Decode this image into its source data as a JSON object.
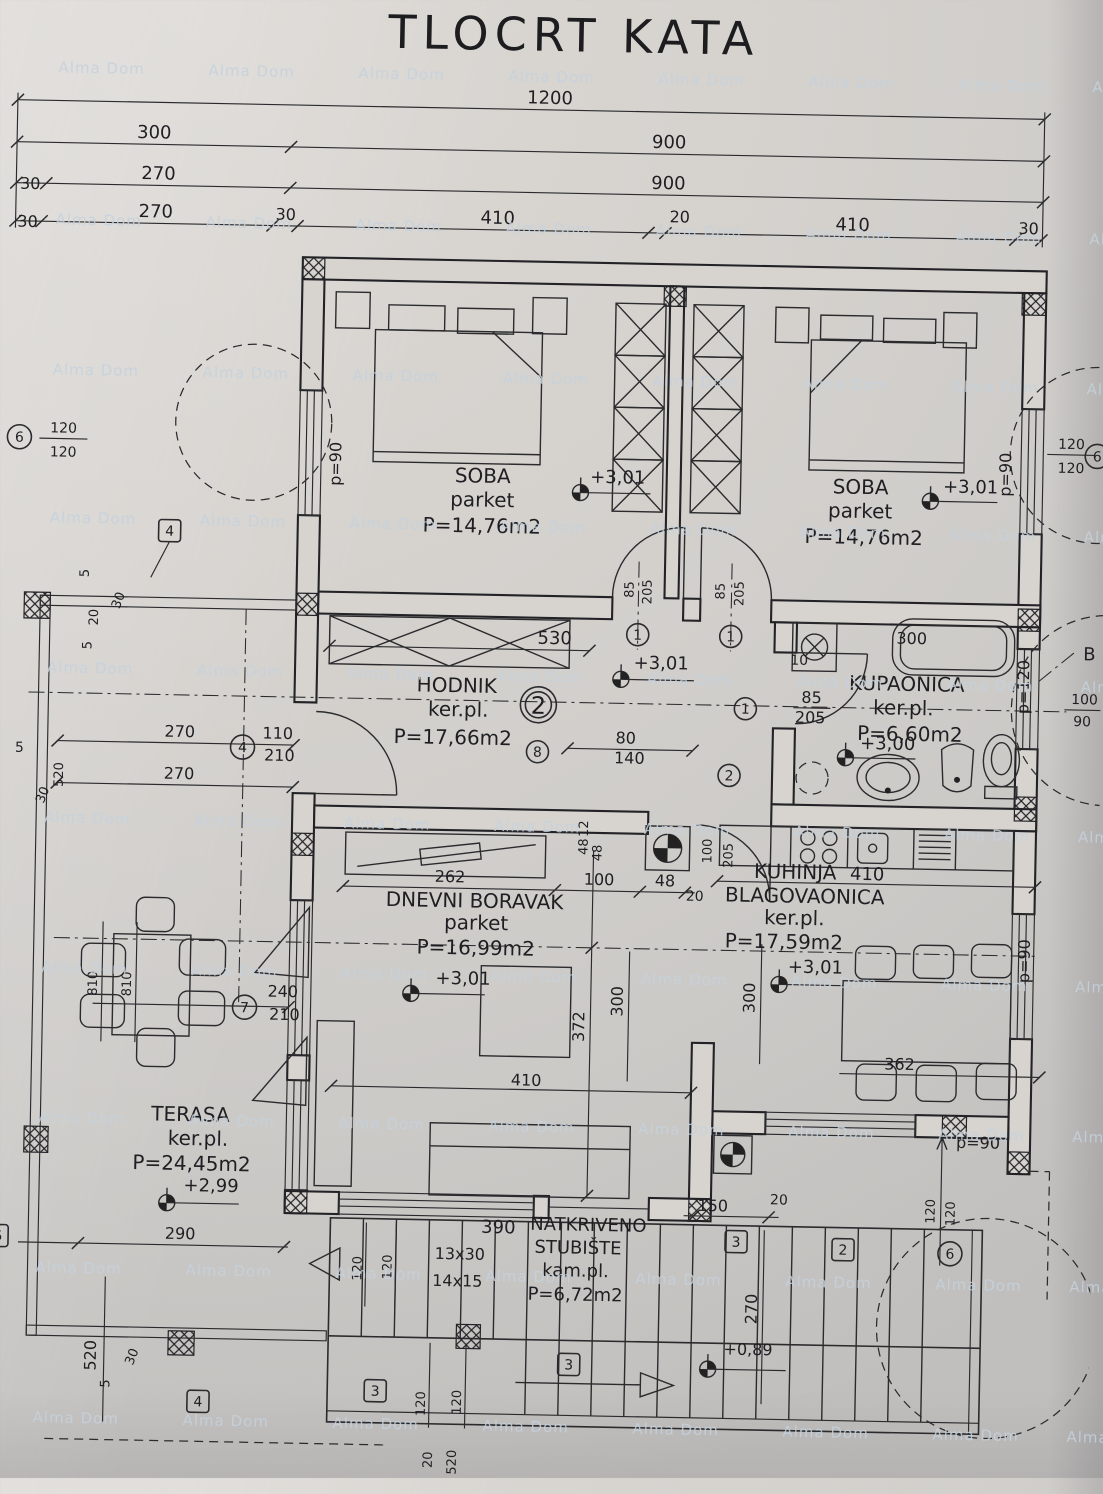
{
  "title": "TLOCRT KATA",
  "watermark": "Alma Dom",
  "section_label": "B",
  "rooms": {
    "soba1": {
      "name": "SOBA",
      "floor": "parket",
      "area": "P=14,76m2",
      "elev": "+3,01"
    },
    "soba2": {
      "name": "SOBA",
      "floor": "parket",
      "area": "P=14,76m2",
      "elev": "+3,01"
    },
    "hodnik": {
      "name": "HODNIK",
      "floor": "ker.pl.",
      "area": "P=17,66m2",
      "elev": "+3,01",
      "tag": "2"
    },
    "kupaonica": {
      "name": "KUPAONICA",
      "floor": "ker.pl.",
      "area": "P=6,60m2",
      "elev": "+3,00"
    },
    "dnevni": {
      "name": "DNEVNI BORAVAK",
      "floor": "parket",
      "area": "P=16,99m2",
      "elev": "+3,01"
    },
    "kuhinja": {
      "name": "KUHINJA",
      "name2": "BLAGOVAONICA",
      "floor": "ker.pl.",
      "area": "P=17,59m2",
      "elev": "+3,01"
    },
    "terasa": {
      "name": "TERASA",
      "floor": "ker.pl.",
      "area": "P=24,45m2",
      "elev": "+2,99"
    },
    "stubiste": {
      "name": "NATKRIVENO",
      "name2": "STUBIŠTE",
      "floor": "kam.pl.",
      "area": "P=6,72m2",
      "elev": "+0,89",
      "steps1": "13x30",
      "steps2": "14x15"
    }
  },
  "dims": {
    "top": [
      "1200",
      "300",
      "900",
      "30",
      "270",
      "900",
      "30",
      "270",
      "30",
      "410",
      "20",
      "410",
      "30"
    ],
    "d530": "530",
    "d85": "85",
    "d205": "205",
    "d80": "80",
    "d140": "140",
    "d100": "100",
    "d110": "110",
    "d210": "210",
    "d240": "240",
    "d262": "262",
    "d48": "48",
    "d20": "20",
    "d12": "12",
    "d372": "372",
    "d300": "300",
    "d410": "410",
    "d362": "362",
    "d270": "270",
    "d290": "290",
    "d520": "520",
    "d30": "30",
    "d5": "5",
    "d810": "810",
    "d10": "10",
    "d120": "120",
    "d90": "90",
    "d150": "150",
    "d390": "390"
  },
  "windows": {
    "p90": "p=90",
    "p120": "p=120"
  },
  "markers": {
    "n1": "1",
    "n2": "2",
    "n3": "3",
    "n4": "4",
    "n5": "5",
    "n6": "6",
    "n7": "7",
    "n8": "8"
  }
}
